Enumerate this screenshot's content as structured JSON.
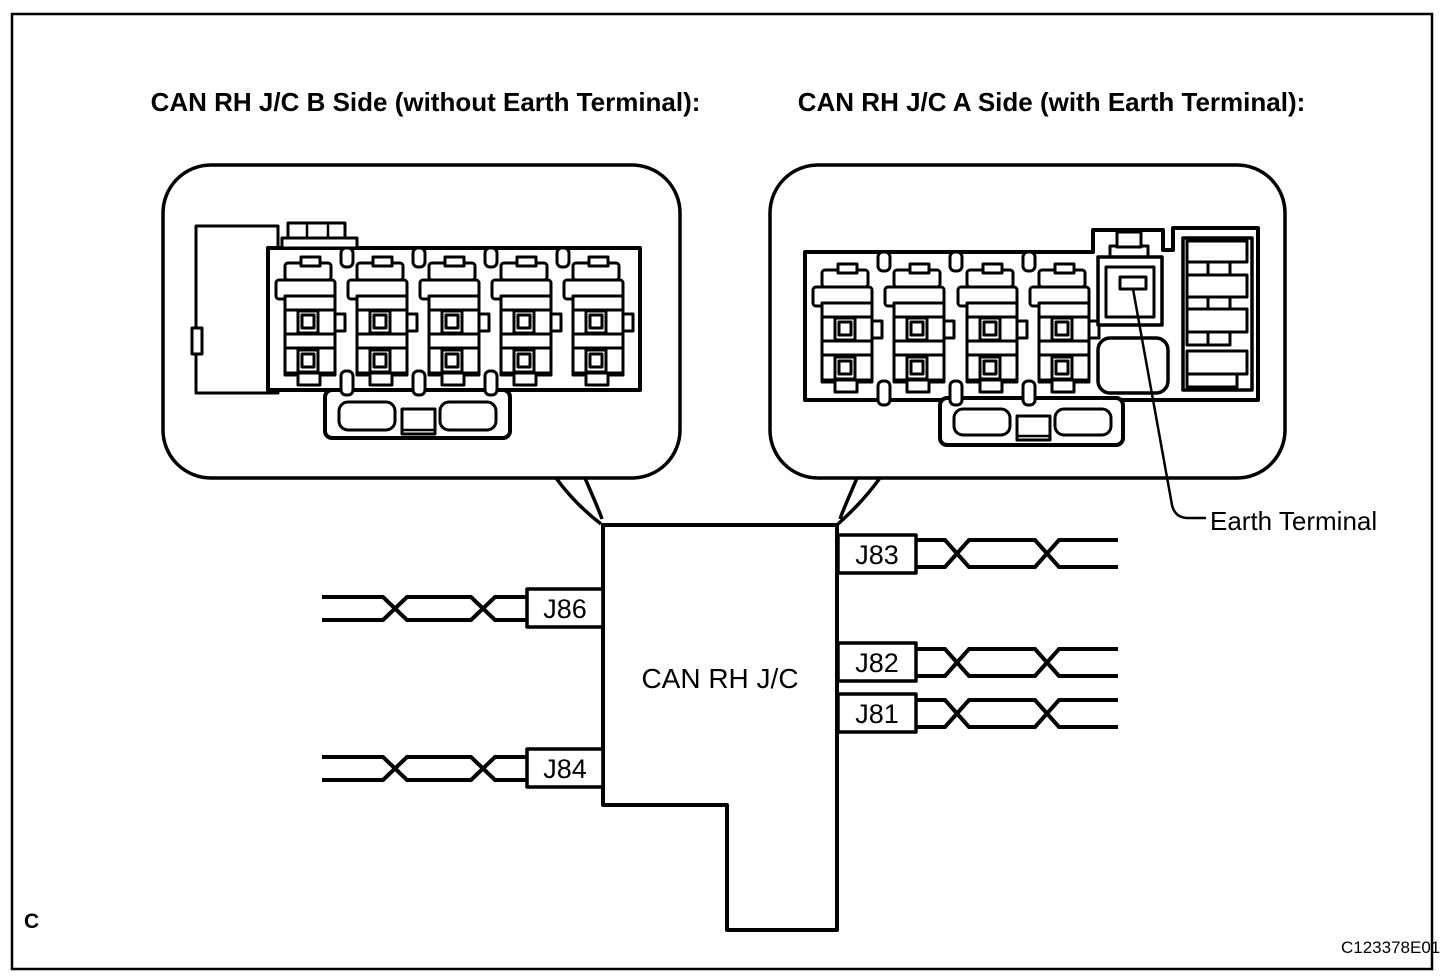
{
  "figure": {
    "background_color": "#ffffff",
    "line_color": "#000000"
  },
  "titles": {
    "b_side": "CAN RH J/C B Side (without Earth Terminal):",
    "a_side": "CAN RH J/C A Side (with Earth Terminal):"
  },
  "junction_block": {
    "label": "CAN RH J/C"
  },
  "wire_labels": {
    "left": [
      "J86",
      "J84"
    ],
    "right": [
      "J83",
      "J82",
      "J81"
    ]
  },
  "annotations": {
    "earth_terminal": "Earth Terminal"
  },
  "footer": {
    "corner_letter": "C",
    "figure_code": "C123378E01"
  }
}
